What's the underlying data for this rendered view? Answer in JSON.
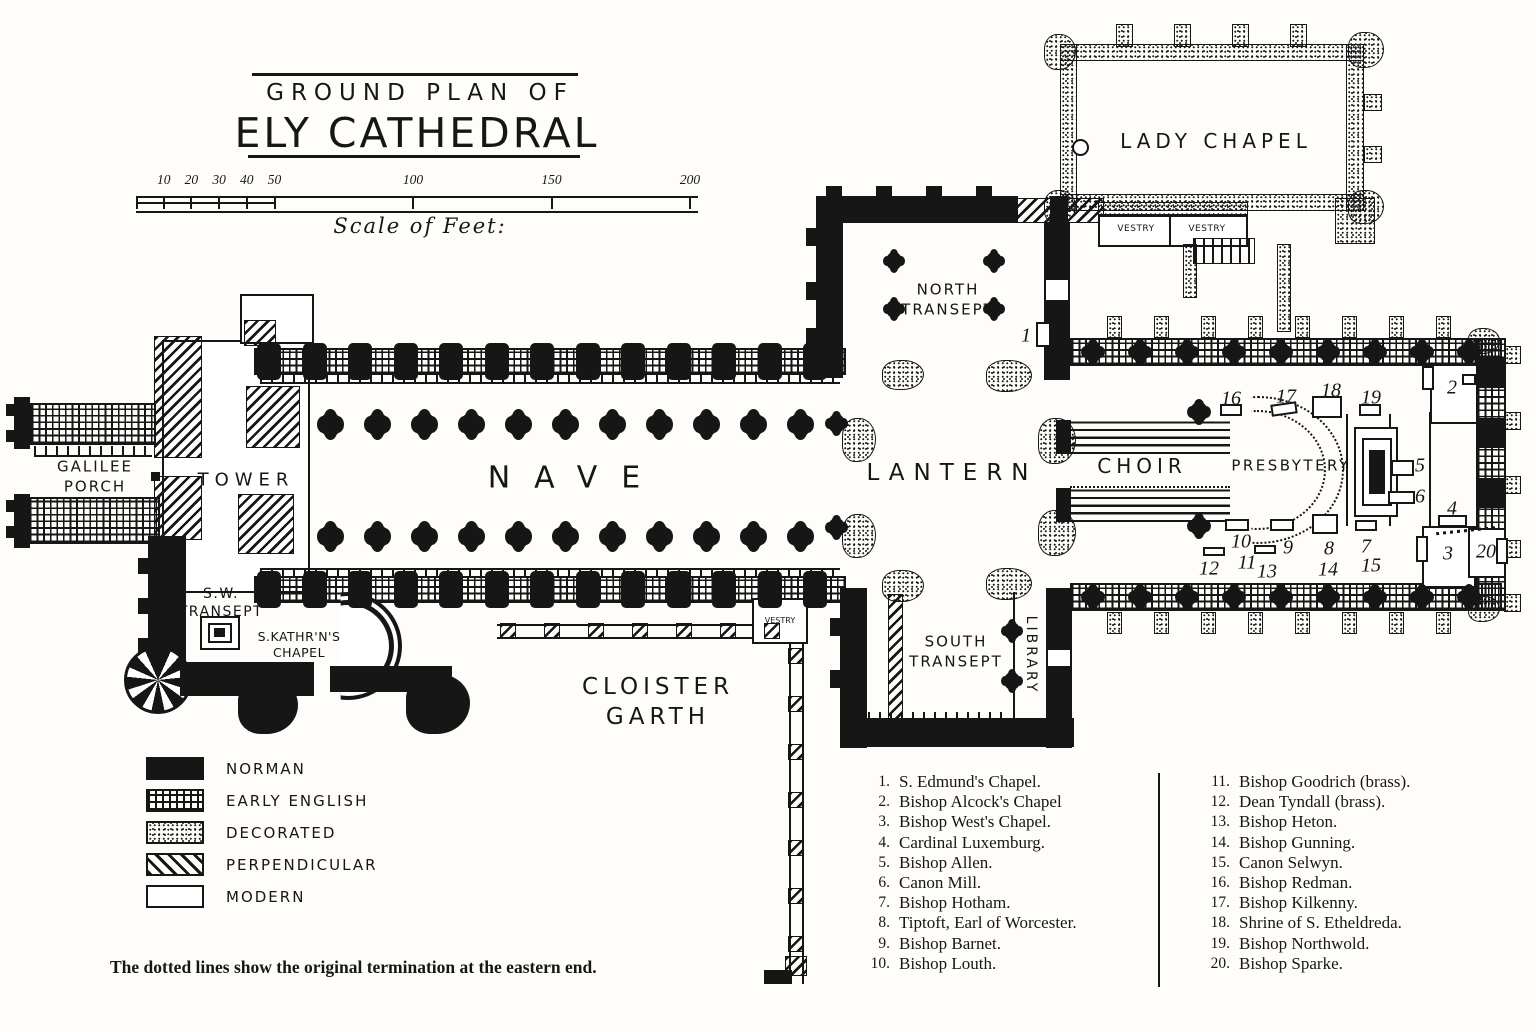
{
  "title": {
    "kicker": "GROUND PLAN OF",
    "name": "ELY CATHEDRAL"
  },
  "scale_bar": {
    "caption": "Scale of Feet:",
    "unit_ticks": [
      {
        "ft": 10,
        "label": "10"
      },
      {
        "ft": 20,
        "label": "20"
      },
      {
        "ft": 30,
        "label": "30"
      },
      {
        "ft": 40,
        "label": "40"
      },
      {
        "ft": 50,
        "label": "50"
      },
      {
        "ft": 100,
        "label": "100"
      },
      {
        "ft": 150,
        "label": "150"
      },
      {
        "ft": 200,
        "label": "200"
      }
    ]
  },
  "plan": {
    "labels": {
      "galilee_porch": "GALILEE\nPORCH",
      "tower": "TOWER",
      "nave": "NAVE",
      "north_transept": "NORTH\nTRANSEPT",
      "lantern": "LANTERN",
      "choir": "CHOIR",
      "presbytery": "PRESBYTERY",
      "lady_chapel": "LADY CHAPEL",
      "vestry_north_1": "VESTRY",
      "vestry_north_2": "VESTRY",
      "south_transept": "SOUTH\nTRANSEPT",
      "library": "LIBRARY",
      "sw_transept": "S.W.\nTRANSEPT",
      "s_katharines_chapel": "S.KATHR'N'S\nCHAPEL",
      "cloister_garth": "CLOISTER\nGARTH",
      "vestry_cloister": "VESTRY"
    },
    "markers": [
      {
        "n": "1",
        "x": 1026,
        "y": 336
      },
      {
        "n": "2",
        "x": 1452,
        "y": 388
      },
      {
        "n": "3",
        "x": 1448,
        "y": 554
      },
      {
        "n": "4",
        "x": 1452,
        "y": 509
      },
      {
        "n": "5",
        "x": 1420,
        "y": 466
      },
      {
        "n": "6",
        "x": 1420,
        "y": 497
      },
      {
        "n": "7",
        "x": 1366,
        "y": 547
      },
      {
        "n": "8",
        "x": 1329,
        "y": 549
      },
      {
        "n": "9",
        "x": 1288,
        "y": 548
      },
      {
        "n": "10",
        "x": 1241,
        "y": 542
      },
      {
        "n": "11",
        "x": 1247,
        "y": 563
      },
      {
        "n": "12",
        "x": 1209,
        "y": 569
      },
      {
        "n": "13",
        "x": 1267,
        "y": 572
      },
      {
        "n": "14",
        "x": 1328,
        "y": 570
      },
      {
        "n": "15",
        "x": 1371,
        "y": 566
      },
      {
        "n": "16",
        "x": 1231,
        "y": 399
      },
      {
        "n": "17",
        "x": 1286,
        "y": 397
      },
      {
        "n": "18",
        "x": 1331,
        "y": 391
      },
      {
        "n": "19",
        "x": 1371,
        "y": 398
      },
      {
        "n": "20",
        "x": 1486,
        "y": 552
      }
    ]
  },
  "legend": {
    "items": [
      {
        "label": "NORMAN",
        "pattern": "norman"
      },
      {
        "label": "EARLY ENGLISH",
        "pattern": "early-english"
      },
      {
        "label": "DECORATED",
        "pattern": "decorated"
      },
      {
        "label": "PERPENDICULAR",
        "pattern": "perpendicular"
      },
      {
        "label": "MODERN",
        "pattern": "modern"
      }
    ]
  },
  "monuments": {
    "col1": [
      {
        "num": "1.",
        "name": "S. Edmund's Chapel."
      },
      {
        "num": "2.",
        "name": "Bishop Alcock's Chapel"
      },
      {
        "num": "3.",
        "name": "Bishop West's Chapel."
      },
      {
        "num": "4.",
        "name": "Cardinal Luxemburg."
      },
      {
        "num": "5.",
        "name": "Bishop Allen."
      },
      {
        "num": "6.",
        "name": "Canon Mill."
      },
      {
        "num": "7.",
        "name": "Bishop Hotham."
      },
      {
        "num": "8.",
        "name": "Tiptoft, Earl of Worcester."
      },
      {
        "num": "9.",
        "name": "Bishop Barnet."
      },
      {
        "num": "10.",
        "name": "Bishop Louth."
      }
    ],
    "col2": [
      {
        "num": "11.",
        "name": "Bishop Goodrich (brass)."
      },
      {
        "num": "12.",
        "name": "Dean Tyndall (brass)."
      },
      {
        "num": "13.",
        "name": "Bishop Heton."
      },
      {
        "num": "14.",
        "name": "Bishop Gunning."
      },
      {
        "num": "15.",
        "name": "Canon Selwyn."
      },
      {
        "num": "16.",
        "name": "Bishop Redman."
      },
      {
        "num": "17.",
        "name": "Bishop Kilkenny."
      },
      {
        "num": "18.",
        "name": "Shrine of S. Etheldreda."
      },
      {
        "num": "19.",
        "name": "Bishop Northwold."
      },
      {
        "num": "20.",
        "name": "Bishop Sparke."
      }
    ]
  },
  "footnote": "The dotted lines show the original termination at the eastern end.",
  "colors": {
    "ink": "#161616",
    "paper": "#fffdfa"
  }
}
